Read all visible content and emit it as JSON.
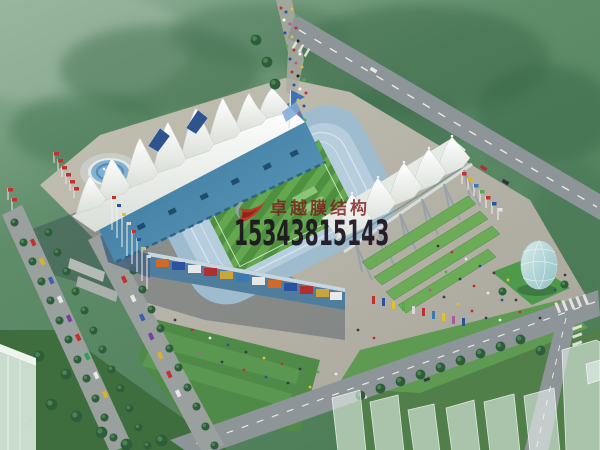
{
  "image": {
    "title": "Aerial architectural rendering of a stadium with white tensile membrane roofs",
    "type": "architectural-rendering"
  },
  "watermark": {
    "company_name": "卓越膜结构",
    "phone": "15343815143",
    "name_color": "#7c1a1c",
    "phone_color": "#1c121e",
    "logo": "red-swoosh-logo"
  },
  "scene": {
    "elements": [
      "forest",
      "main-road",
      "tree-lined-avenue",
      "parking-cars",
      "plaza",
      "fountain",
      "west-stand-membrane-cones",
      "blue-grandstand-roof",
      "football-pitch",
      "seating-bowl",
      "south-facade-banners",
      "east-stand-membrane-roof",
      "steel-pylons",
      "grass-terraces",
      "flag-rows",
      "crowd",
      "glass-egg-pavilion",
      "crosswalk",
      "ghost-buildings",
      "lawns"
    ],
    "colors": {
      "forest": "#55815f",
      "plaza": "#b6b3a8",
      "road": "#8e9598",
      "roof_blue": "#3c7aa0",
      "membrane_white": "#f2f4ef",
      "pitch_green": "#58a04a",
      "seats_blue": "#a9c4d6",
      "lawn_green": "#4f8a49",
      "glass_egg": "#aed2d0"
    }
  }
}
